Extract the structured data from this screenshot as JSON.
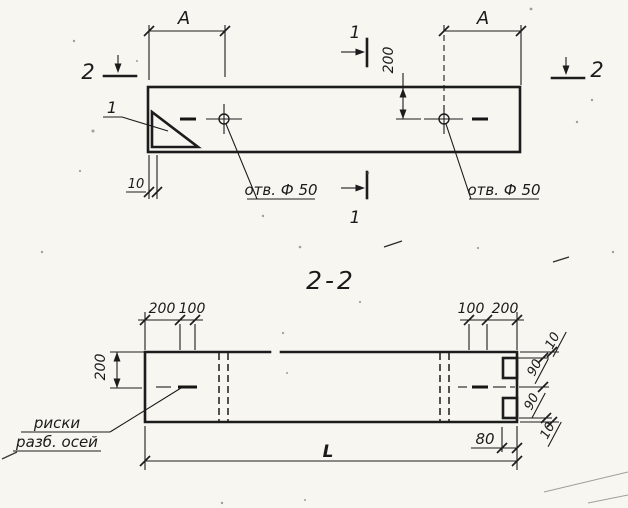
{
  "drawing": {
    "plan": {
      "marker_2_left": "2",
      "marker_2_right": "2",
      "marker_1_top": "1",
      "marker_1_bottom": "1",
      "detail_callout": "1",
      "dim_a_left": "A",
      "dim_a_right": "A",
      "dim_200": "200",
      "dim_10": "10",
      "hole_left_label": "отв. Ф 50",
      "hole_right_label": "отв. Ф 50"
    },
    "section": {
      "title": "2-2",
      "dims_top_left": [
        "200",
        "100"
      ],
      "dims_top_right": [
        "100",
        "200"
      ],
      "dim_height_200": "200",
      "dims_right": [
        "10",
        "90",
        "90",
        "10"
      ],
      "dim_80": "80",
      "dim_length": "L",
      "axis_note_line1": "риски",
      "axis_note_line2": "разб. осей"
    },
    "colors": {
      "ink": "#1c1c1c",
      "paper": "#f7f6f1"
    }
  }
}
